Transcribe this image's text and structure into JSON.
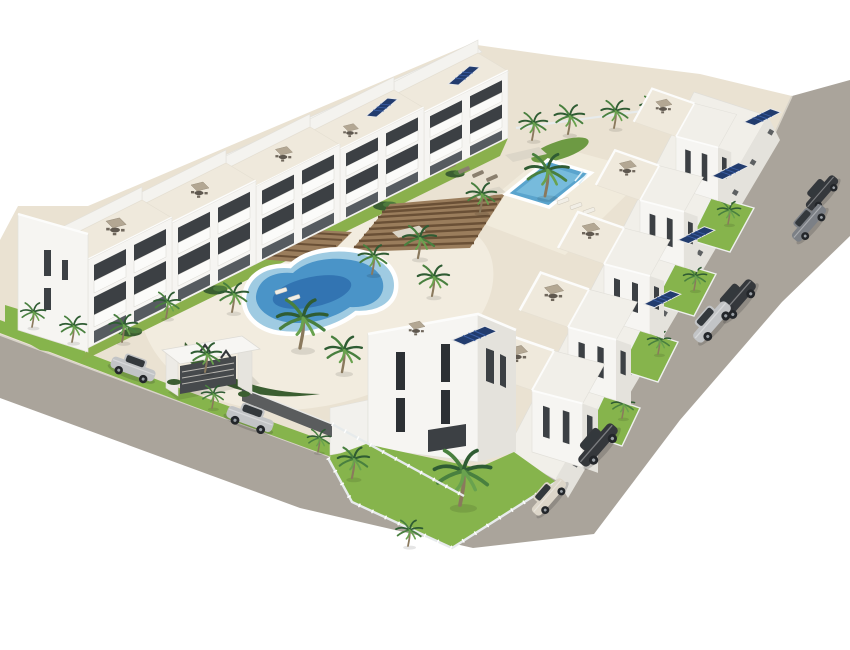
{
  "scene": {
    "title": "Aerial 3D render of a white Mediterranean apartment complex with two pools, palm trees, perimeter roads and parked cars",
    "background": "#ffffff"
  },
  "colors": {
    "road": "#aaa49b",
    "curb": "#d8d3c9",
    "courtyard": "#eae2d2",
    "deck": "#f2ecdf",
    "deck_lap": "#f1ebdc",
    "building_white": "#f6f5f2",
    "building_shade": "#e4e2dc",
    "roof_light": "#f1efe9",
    "terrace": "#efe9dc",
    "rear_band": "#f3f2ee",
    "window_dark": "#3c4044",
    "window_deeper": "#2c3034",
    "rail_white": "#fbfbf9",
    "pool_light": "#9fcbe2",
    "pool_mid": "#4a94c8",
    "pool_deep": "#2e6fae",
    "lap_pool": "#5aa4cd",
    "lap_pool_light": "#7cc0de",
    "grass": "#86b44c",
    "shrub": "#3b5e31",
    "pergola": "#9a7d5c",
    "pergola_slat": "#6a5036",
    "solar": "#223c6e",
    "mesh_fence": "#46494c",
    "glass_fence": "#e7ebec",
    "furniture": "#6f675c",
    "umbrella": "#b3a793",
    "lounger_light": "#f1eee6",
    "lounger_dark": "#8a7f6e",
    "trunk": "#8a795d",
    "car_silver": "#c2c4c6",
    "car_dark": "#35383c",
    "car_gray": "#7c8086",
    "car_cream": "#ddd6c9",
    "gate_white": "#f7f6f3"
  },
  "counts": {
    "building_rows": 2,
    "row_a_segments": 5,
    "row_bc_blocks": 6,
    "palms": 26,
    "cars": 8,
    "solar_arrays": 7,
    "pools": 2,
    "roof_umbrellas": 10
  },
  "pools": [
    {
      "name": "kidney-pool",
      "shape": "organic curved pool in central courtyard"
    },
    {
      "name": "lap-pool",
      "shape": "rectangular pool in upper courtyard"
    }
  ],
  "entrance": {
    "marks": "ΛΛ"
  }
}
